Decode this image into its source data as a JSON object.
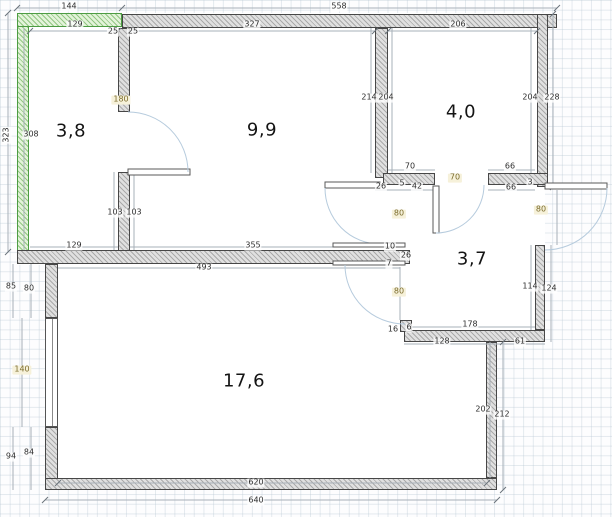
{
  "plan_title": "apartment-floor-plan",
  "rooms": [
    {
      "area": "3,8",
      "x": 71,
      "y": 131
    },
    {
      "area": "9,9",
      "x": 262,
      "y": 130
    },
    {
      "area": "4,0",
      "x": 461,
      "y": 112
    },
    {
      "area": "3,7",
      "x": 472,
      "y": 259
    },
    {
      "area": "17,6",
      "x": 244,
      "y": 381
    }
  ],
  "opening_labels": [
    {
      "text": "180",
      "x": 121,
      "y": 100
    },
    {
      "text": "80",
      "x": 399,
      "y": 214
    },
    {
      "text": "70",
      "x": 455,
      "y": 178
    },
    {
      "text": "80",
      "x": 399,
      "y": 292
    },
    {
      "text": "80",
      "x": 541,
      "y": 210
    },
    {
      "text": "140",
      "x": 22,
      "y": 370
    }
  ],
  "dim_labels": [
    {
      "text": "144",
      "x": 69,
      "y": 7
    },
    {
      "text": "558",
      "x": 339,
      "y": 7
    },
    {
      "text": "129",
      "x": 75,
      "y": 25
    },
    {
      "text": "327",
      "x": 252,
      "y": 25
    },
    {
      "text": "206",
      "x": 458,
      "y": 25
    },
    {
      "text": "25",
      "x": 113,
      "y": 32
    },
    {
      "text": "25",
      "x": 133,
      "y": 32
    },
    {
      "text": "323",
      "x": 7,
      "y": 135,
      "rot": true
    },
    {
      "text": "308",
      "x": 31,
      "y": 135
    },
    {
      "text": "214",
      "x": 369,
      "y": 98
    },
    {
      "text": "204",
      "x": 386,
      "y": 98
    },
    {
      "text": "204",
      "x": 530,
      "y": 98
    },
    {
      "text": "228",
      "x": 552,
      "y": 98
    },
    {
      "text": "70",
      "x": 410,
      "y": 167
    },
    {
      "text": "66",
      "x": 510,
      "y": 167
    },
    {
      "text": "26",
      "x": 381,
      "y": 187
    },
    {
      "text": "5",
      "x": 402,
      "y": 184
    },
    {
      "text": "42",
      "x": 417,
      "y": 187
    },
    {
      "text": "66",
      "x": 511,
      "y": 188
    },
    {
      "text": "3",
      "x": 530,
      "y": 183
    },
    {
      "text": "129",
      "x": 74,
      "y": 246
    },
    {
      "text": "103",
      "x": 115,
      "y": 213
    },
    {
      "text": "103",
      "x": 134,
      "y": 213
    },
    {
      "text": "355",
      "x": 253,
      "y": 246
    },
    {
      "text": "493",
      "x": 204,
      "y": 268
    },
    {
      "text": "10",
      "x": 390,
      "y": 247
    },
    {
      "text": "26",
      "x": 406,
      "y": 256
    },
    {
      "text": "7",
      "x": 389,
      "y": 264
    },
    {
      "text": "16",
      "x": 393,
      "y": 330
    },
    {
      "text": "6",
      "x": 409,
      "y": 328
    },
    {
      "text": "85",
      "x": 11,
      "y": 287
    },
    {
      "text": "80",
      "x": 29,
      "y": 289
    },
    {
      "text": "94",
      "x": 11,
      "y": 457
    },
    {
      "text": "84",
      "x": 29,
      "y": 453
    },
    {
      "text": "620",
      "x": 256,
      "y": 483
    },
    {
      "text": "640",
      "x": 256,
      "y": 501
    },
    {
      "text": "202",
      "x": 483,
      "y": 410
    },
    {
      "text": "212",
      "x": 502,
      "y": 415
    },
    {
      "text": "178",
      "x": 470,
      "y": 325
    },
    {
      "text": "128",
      "x": 442,
      "y": 342
    },
    {
      "text": "61",
      "x": 520,
      "y": 342
    },
    {
      "text": "114",
      "x": 530,
      "y": 287
    },
    {
      "text": "124",
      "x": 549,
      "y": 289
    }
  ]
}
